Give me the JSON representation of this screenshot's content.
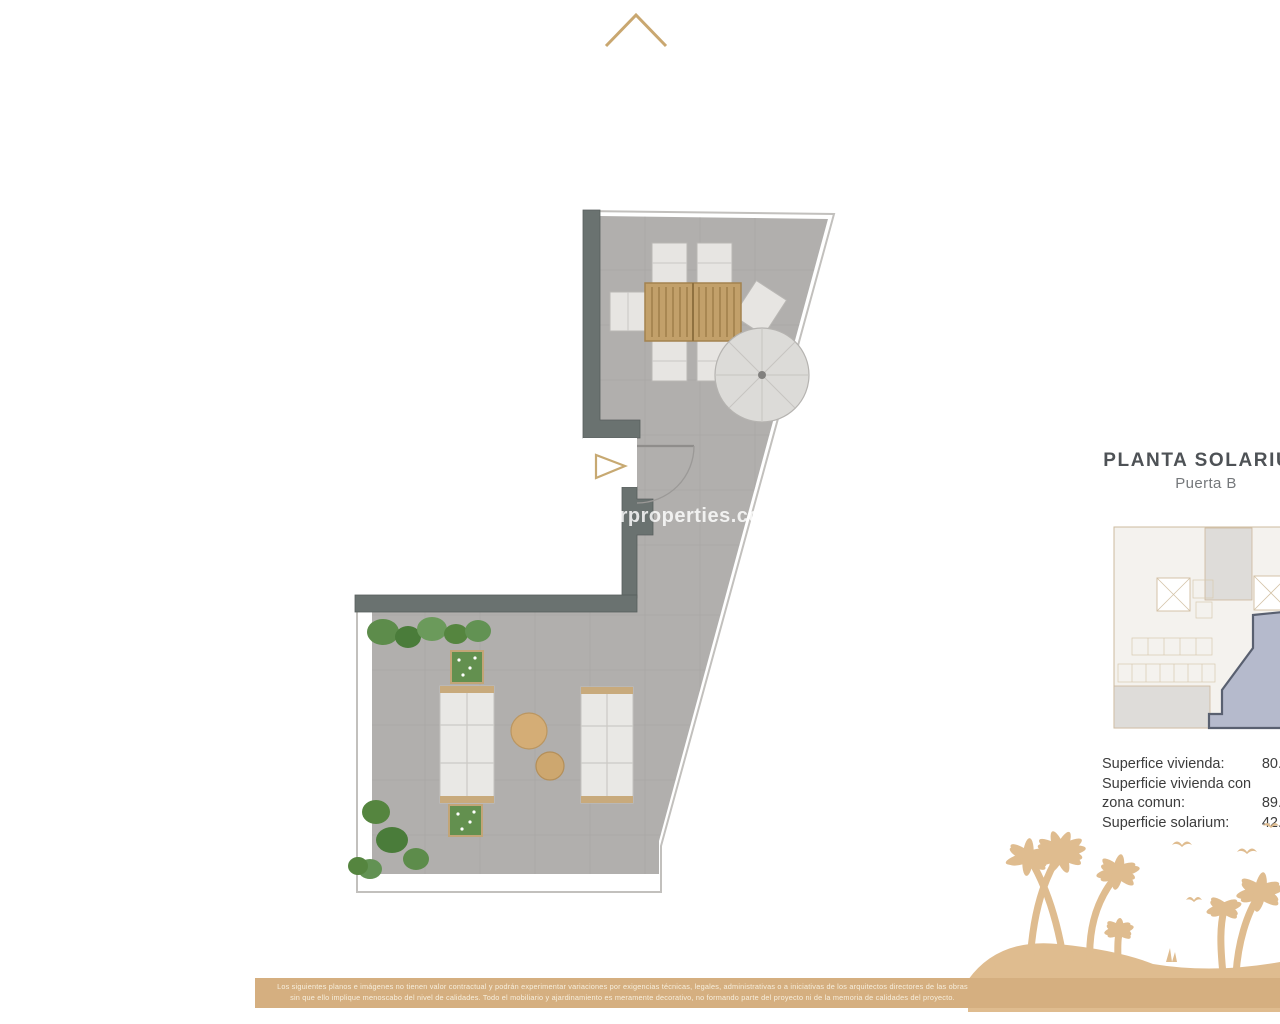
{
  "header": {
    "logo_mark": "gold-chevron"
  },
  "plan_title": {
    "title": "PLANTA SOLARIUM",
    "subtitle": "Puerta B"
  },
  "watermark": "arproperties.co",
  "area_table": {
    "rows": [
      {
        "label": "Superfice vivienda:",
        "value": "80."
      },
      {
        "label": "Superficie vivienda con",
        "value": ""
      },
      {
        "label": "zona comun:",
        "value": "89."
      },
      {
        "label": "Superficie solarium:",
        "value": "42."
      }
    ]
  },
  "disclaimer": {
    "line1": "Los siguientes planos e imágenes no tienen valor contractual y podrán experimentar variaciones por exigencias técnicas, legales, administrativas o a iniciativas de los arquitectos directores de las obras",
    "line2": "sin que ello implique menoscabo del nivel de calidades. Todo el mobiliario y ajardinamiento es meramente decorativo, no formando parte del proyecto ni de la memoria de calidades del proyecto."
  },
  "colors": {
    "accent_gold": "#d5af80",
    "palm_gold": "#dfbc8f",
    "wall_dark": "#6a7270",
    "floor_gray": "#b1afad",
    "highlight_unit_fill": "#b5bacc",
    "highlight_unit_stroke": "#596070",
    "title_text": "#4e5256"
  },
  "floorplan": {
    "items": [
      "dining-table",
      "dining-chairs",
      "parasol",
      "entrance-door",
      "entrance-arrow",
      "sun-lounger-left",
      "sun-lounger-right",
      "side-table-large",
      "side-table-small",
      "planter-top",
      "planter-bottom",
      "shrubs"
    ]
  },
  "keyplan": {
    "highlight": "unit-b-solarium"
  }
}
